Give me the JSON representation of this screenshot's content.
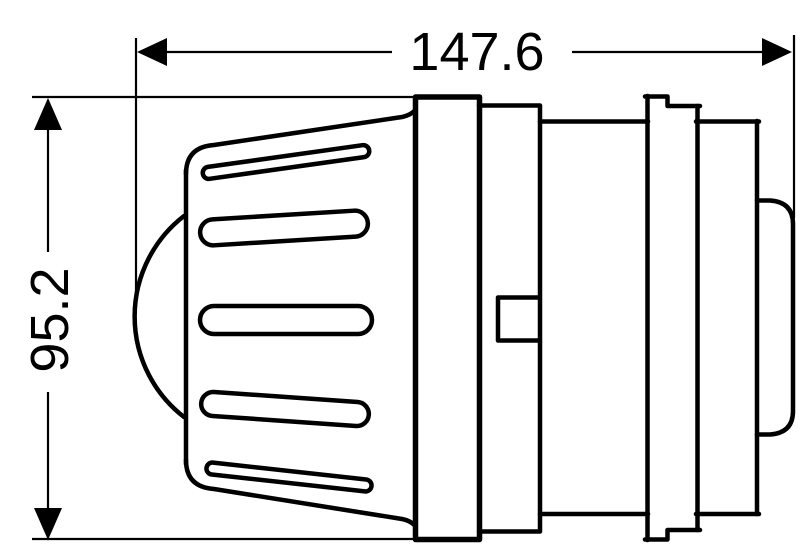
{
  "dimensions": {
    "horizontal": {
      "label": "147.6"
    },
    "vertical": {
      "label": "95.2"
    }
  },
  "style": {
    "line_color": "#000000",
    "background_color": "#ffffff"
  }
}
